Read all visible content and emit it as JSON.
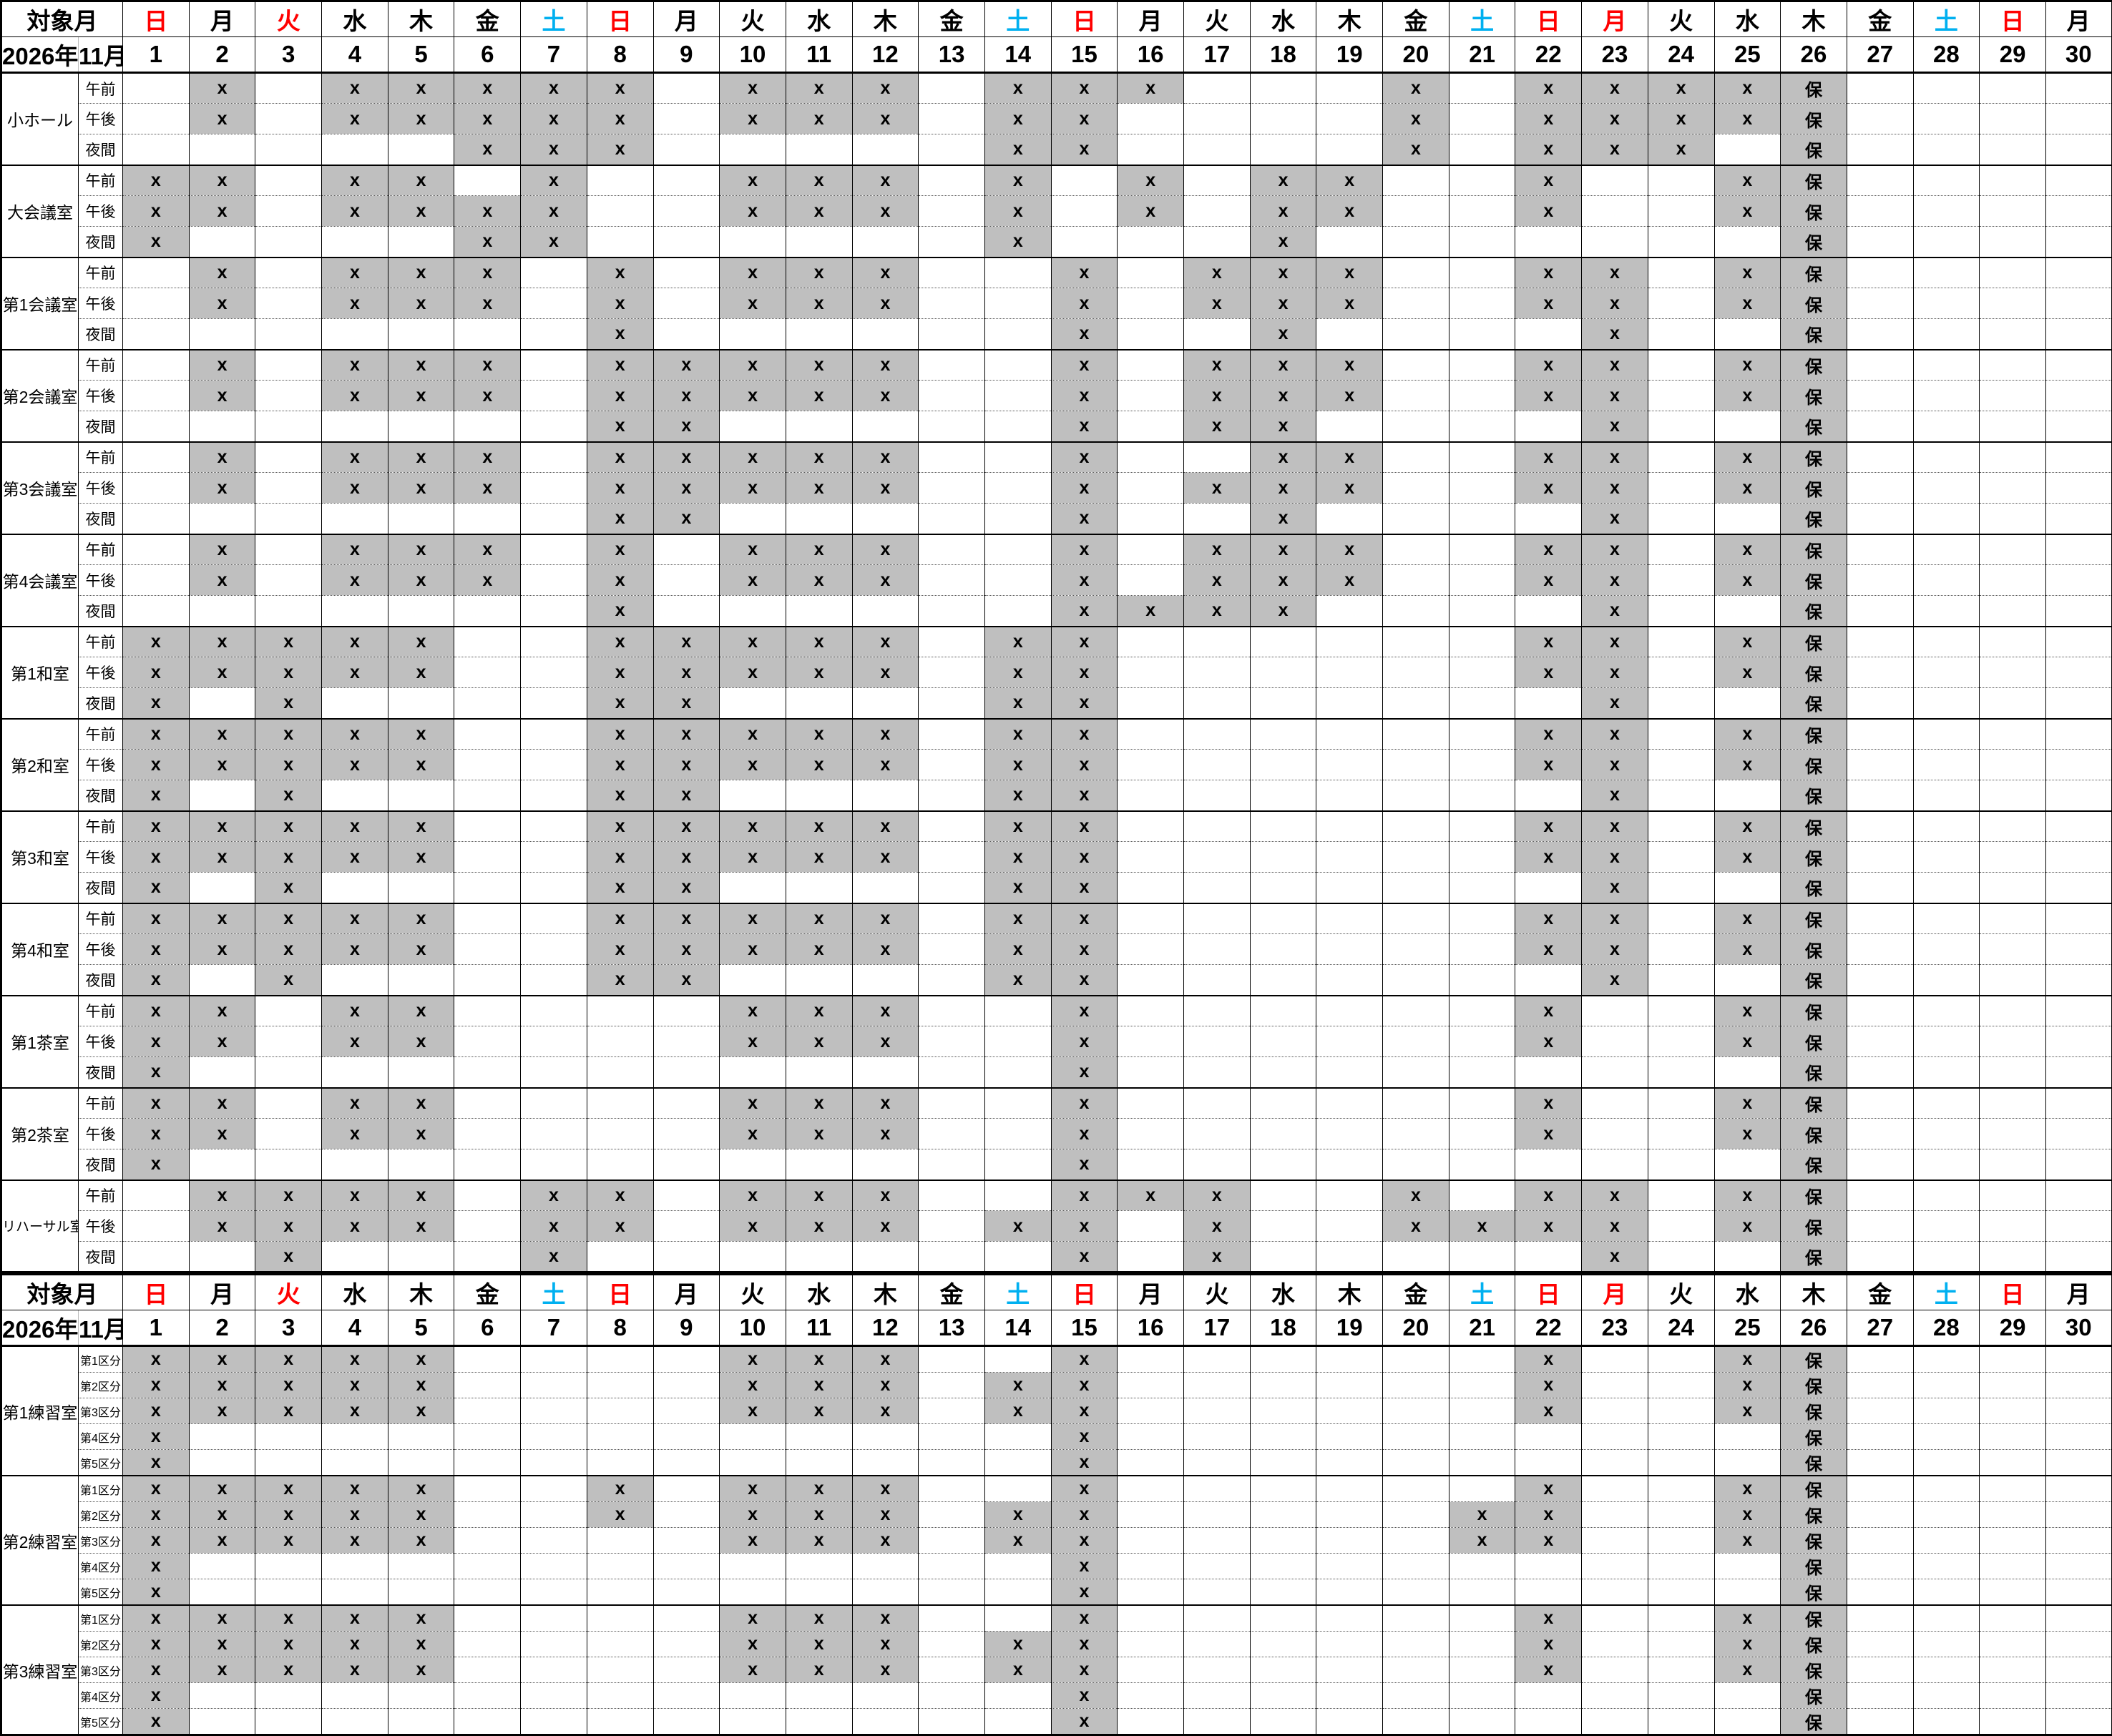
{
  "header": {
    "target_month_label": "対象月",
    "year_label": "2026年",
    "month_label": "11月",
    "days": [
      {
        "n": "1",
        "w": "日",
        "t": "r"
      },
      {
        "n": "2",
        "w": "月",
        "t": "k"
      },
      {
        "n": "3",
        "w": "火",
        "t": "r"
      },
      {
        "n": "4",
        "w": "水",
        "t": "k"
      },
      {
        "n": "5",
        "w": "木",
        "t": "k"
      },
      {
        "n": "6",
        "w": "金",
        "t": "k"
      },
      {
        "n": "7",
        "w": "土",
        "t": "b"
      },
      {
        "n": "8",
        "w": "日",
        "t": "r"
      },
      {
        "n": "9",
        "w": "月",
        "t": "k"
      },
      {
        "n": "10",
        "w": "火",
        "t": "k"
      },
      {
        "n": "11",
        "w": "水",
        "t": "k"
      },
      {
        "n": "12",
        "w": "木",
        "t": "k"
      },
      {
        "n": "13",
        "w": "金",
        "t": "k"
      },
      {
        "n": "14",
        "w": "土",
        "t": "b"
      },
      {
        "n": "15",
        "w": "日",
        "t": "r"
      },
      {
        "n": "16",
        "w": "月",
        "t": "k"
      },
      {
        "n": "17",
        "w": "火",
        "t": "k"
      },
      {
        "n": "18",
        "w": "水",
        "t": "k"
      },
      {
        "n": "19",
        "w": "木",
        "t": "k"
      },
      {
        "n": "20",
        "w": "金",
        "t": "k"
      },
      {
        "n": "21",
        "w": "土",
        "t": "b"
      },
      {
        "n": "22",
        "w": "日",
        "t": "r"
      },
      {
        "n": "23",
        "w": "月",
        "t": "r"
      },
      {
        "n": "24",
        "w": "火",
        "t": "k"
      },
      {
        "n": "25",
        "w": "水",
        "t": "k"
      },
      {
        "n": "26",
        "w": "木",
        "t": "k"
      },
      {
        "n": "27",
        "w": "金",
        "t": "k"
      },
      {
        "n": "28",
        "w": "土",
        "t": "b"
      },
      {
        "n": "29",
        "w": "日",
        "t": "r"
      },
      {
        "n": "30",
        "w": "月",
        "t": "k"
      }
    ]
  },
  "legend": {
    "booked_mark": "x",
    "maintenance_mark": "保"
  },
  "colors": {
    "booked_bg": "#bfbfbf",
    "sunday_holiday": "#ff0000",
    "saturday": "#00b0f0"
  },
  "sections": [
    {
      "slots": [
        "午前",
        "午後",
        "夜間"
      ],
      "rooms": [
        {
          "name": "小ホール",
          "rows": [
            ".x.xxxxx.xxx.xxx...x.xxxx保....",
            ".x.xxxxx.xxx.xx....x.xxxx保....",
            ".....xxx.....xx....x.xxx.保...."
          ]
        },
        {
          "name": "大会議室",
          "rows": [
            "xx.xx.x..xxx.x.x.xx..x..x保....",
            "xx.xxxx..xxx.x.x.xx..x..x保....",
            "x....xx......x...x.......保...."
          ]
        },
        {
          "name": "第1会議室",
          "rows": [
            ".x.xxx.x.xxx..x.xxx..xx.x保....",
            ".x.xxx.x.xxx..x.xxx..xx.x保....",
            ".......x......x..x....x..保...."
          ]
        },
        {
          "name": "第2会議室",
          "rows": [
            ".x.xxx.xxxxx..x.xxx..xx.x保....",
            ".x.xxx.xxxxx..x.xxx..xx.x保....",
            ".......xx.....x.xx....x..保...."
          ]
        },
        {
          "name": "第3会議室",
          "rows": [
            ".x.xxx.xxxxx..x..xx..xx.x保....",
            ".x.xxx.xxxxx..x.xxx..xx.x保....",
            ".......xx.....x..x....x..保...."
          ]
        },
        {
          "name": "第4会議室",
          "rows": [
            ".x.xxx.x.xxx..x.xxx..xx.x保....",
            ".x.xxx.x.xxx..x.xxx..xx.x保....",
            ".......x......xxxx....x..保...."
          ]
        },
        {
          "name": "第1和室",
          "rows": [
            "xxxxx..xxxxx.xx......xx.x保....",
            "xxxxx..xxxxx.xx......xx.x保....",
            "x.x....xx....xx.......x..保...."
          ]
        },
        {
          "name": "第2和室",
          "rows": [
            "xxxxx..xxxxx.xx......xx.x保....",
            "xxxxx..xxxxx.xx......xx.x保....",
            "x.x....xx....xx.......x..保...."
          ]
        },
        {
          "name": "第3和室",
          "rows": [
            "xxxxx..xxxxx.xx......xx.x保....",
            "xxxxx..xxxxx.xx......xx.x保....",
            "x.x....xx....xx.......x..保...."
          ]
        },
        {
          "name": "第4和室",
          "rows": [
            "xxxxx..xxxxx.xx......xx.x保....",
            "xxxxx..xxxxx.xx......xx.x保....",
            "x.x....xx....xx.......x..保...."
          ]
        },
        {
          "name": "第1茶室",
          "rows": [
            "xx.xx....xxx..x......x..x保....",
            "xx.xx....xxx..x......x..x保....",
            "x.............x..........保...."
          ]
        },
        {
          "name": "第2茶室",
          "rows": [
            "xx.xx....xxx..x......x..x保....",
            "xx.xx....xxx..x......x..x保....",
            "x.............x..........保...."
          ]
        },
        {
          "name": "リハーサル室",
          "rows": [
            ".xxxx.xx.xxx..xxx..x.xx.x保....",
            ".xxxx.xx.xxx.xx.x..xxxx.x保....",
            "..x...x.......x.x.....x..保...."
          ]
        }
      ]
    },
    {
      "slots": [
        "第1区分",
        "第2区分",
        "第3区分",
        "第4区分",
        "第5区分"
      ],
      "rooms": [
        {
          "name": "第1練習室",
          "rows": [
            "xxxxx....xxx..x......x..x保....",
            "xxxxx....xxx.xx......x..x保....",
            "xxxxx....xxx.xx......x..x保....",
            "x.............x..........保....",
            "x.............x..........保...."
          ]
        },
        {
          "name": "第2練習室",
          "rows": [
            "xxxxx..x.xxx..x......x..x保....",
            "xxxxx..x.xxx.xx.....xx..x保....",
            "xxxxx....xxx.xx.....xx..x保....",
            "x.............x..........保....",
            "x.............x..........保...."
          ]
        },
        {
          "name": "第3練習室",
          "rows": [
            "xxxxx....xxx..x......x..x保....",
            "xxxxx....xxx.xx......x..x保....",
            "xxxxx....xxx.xx......x..x保....",
            "x.............x..........保....",
            "x.............x..........保...."
          ]
        }
      ]
    }
  ]
}
